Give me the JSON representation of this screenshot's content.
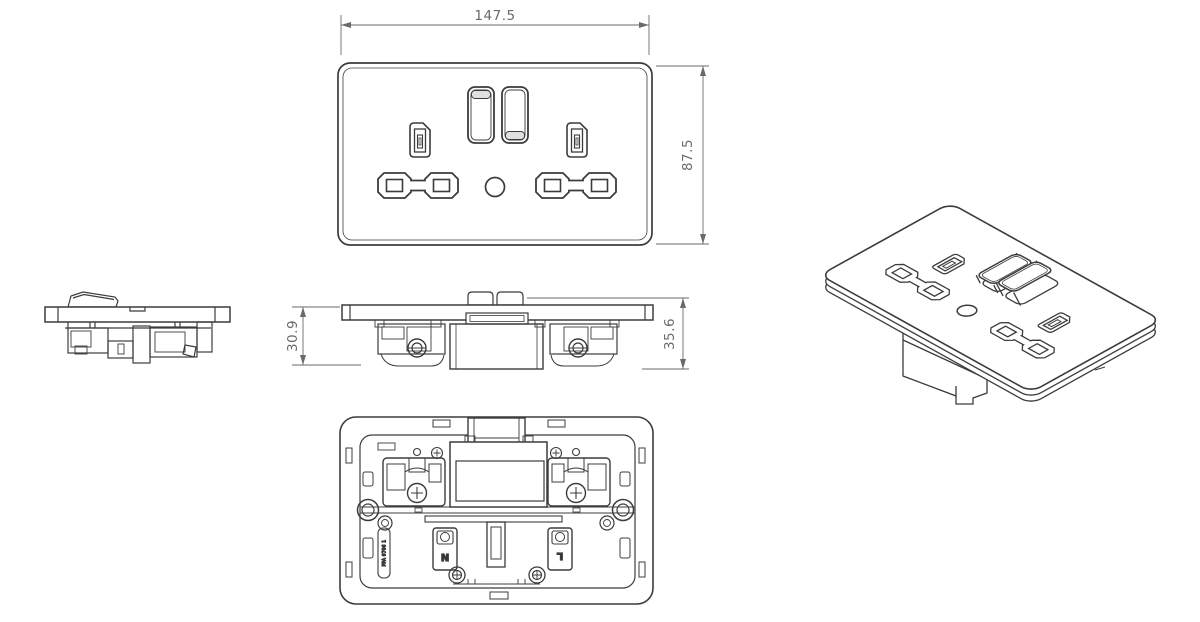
{
  "colors": {
    "background": "#ffffff",
    "line": "#3c3c3c",
    "dimension_text": "#6a6a6a",
    "rocker_shade": "#e0e0e0"
  },
  "views": {
    "front": {
      "width_dim": "147.5",
      "height_dim": "87.5"
    },
    "side_bottom": {
      "depth_dim": "30.9",
      "overall_depth_dim": "35.6"
    },
    "rear": {
      "neutral_label": "N",
      "live_label": "L",
      "stamp_text": "PPA 0706 1"
    }
  }
}
